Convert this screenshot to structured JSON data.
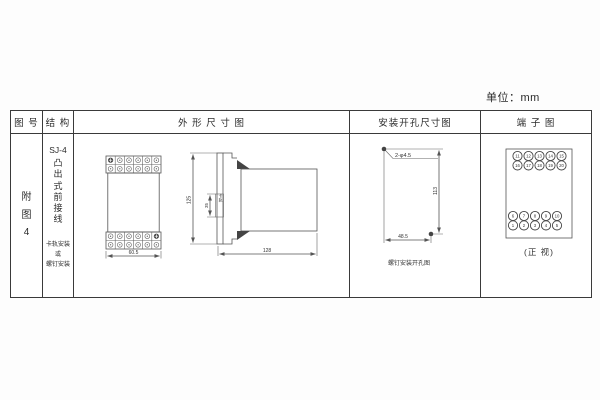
{
  "unit_label": "单位：mm",
  "headers": {
    "figure_no": "图 号",
    "structure": "结 构",
    "outline": "外 形 尺 寸 图",
    "mounting": "安装开孔尺寸图",
    "terminal": "端 子 图"
  },
  "figure_no": "附图4",
  "structure": {
    "model": "SJ-4",
    "type_text": "凸出式前接线",
    "mount_note_1": "卡轨安装",
    "mount_note_2": "或",
    "mount_note_3": "螺钉安装"
  },
  "outline": {
    "front_width": "60.5",
    "height": "125",
    "rail_dim": "35",
    "rail_label": "卡轨",
    "depth": "128"
  },
  "mounting": {
    "holes_label": "2-φ4.5",
    "vertical_dim": "113",
    "horizontal_dim": "48.5",
    "caption": "螺钉安装开孔图"
  },
  "terminal": {
    "rows": [
      [
        "11",
        "12",
        "13",
        "14",
        "15"
      ],
      [
        "16",
        "17",
        "18",
        "19",
        "20"
      ],
      [
        "6",
        "7",
        "8",
        "9",
        "10"
      ],
      [
        "1",
        "2",
        "3",
        "4",
        "5"
      ]
    ],
    "caption": "(正 视)"
  }
}
